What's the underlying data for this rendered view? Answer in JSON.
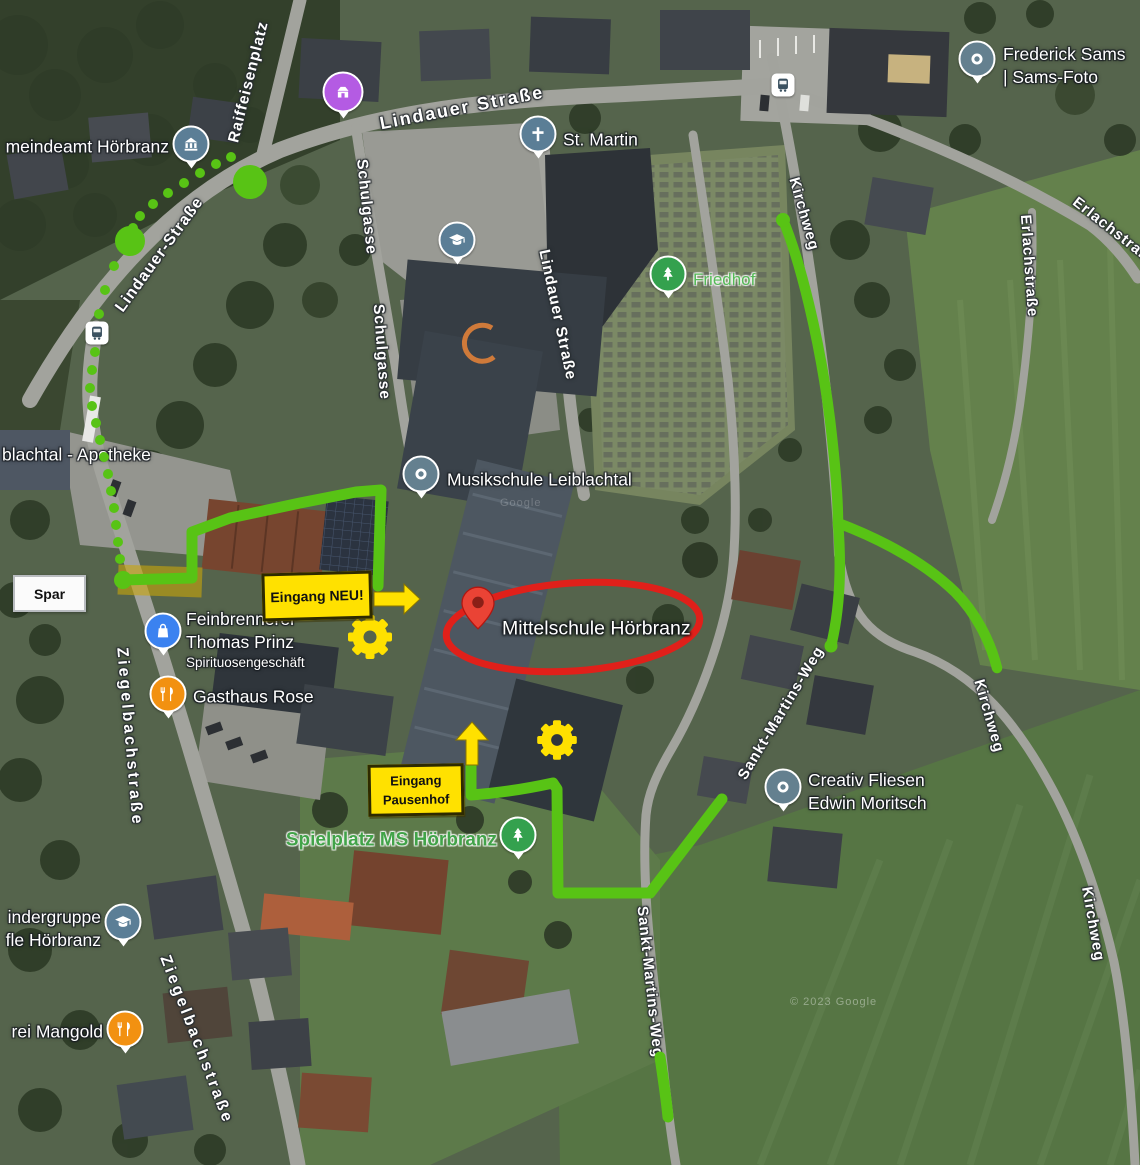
{
  "colors": {
    "route_green": "#58c315",
    "annotation_yellow": "#ffe100",
    "annotation_red": "#e0201a",
    "poi_blue_grey": "#5b7e96",
    "poi_generic_grey": "#64808f",
    "poi_green": "#34a14e",
    "poi_blue": "#3b82f0",
    "poi_orange": "#f29111",
    "poi_purple": "#b45be3",
    "pin_red": "#ea4335"
  },
  "annotations": {
    "eingang_neu": "Eingang NEU!",
    "eingang_pausenhof_line1": "Eingang",
    "eingang_pausenhof_line2": "Pausenhof",
    "spar": "Spar",
    "target_label": "Mittelschule Hörbranz",
    "watermark_small": "Google",
    "watermark_bottom": "© 2023 Google"
  },
  "street_labels": [
    {
      "text": "Raiffeisenplatz",
      "x": 249,
      "y": 82,
      "rot": -76,
      "size": 15.5,
      "sp": 1
    },
    {
      "text": "Lindauer Straße",
      "x": 462,
      "y": 108,
      "rot": -11,
      "size": 18,
      "sp": 2
    },
    {
      "text": "Lindauer-Straße",
      "x": 160,
      "y": 255,
      "rot": -54,
      "size": 16,
      "sp": 1
    },
    {
      "text": "Schulgasse",
      "x": 366,
      "y": 207,
      "rot": 84,
      "size": 15.5,
      "sp": 1
    },
    {
      "text": "Schulgasse",
      "x": 381,
      "y": 352,
      "rot": 86,
      "size": 15.5,
      "sp": 1
    },
    {
      "text": "Lindauer Straße",
      "x": 557,
      "y": 315,
      "rot": 78,
      "size": 15.5,
      "sp": 1
    },
    {
      "text": "Kirchweg",
      "x": 804,
      "y": 214,
      "rot": 74,
      "size": 15,
      "sp": 1
    },
    {
      "text": "Erlachstraße",
      "x": 1115,
      "y": 232,
      "rot": 38,
      "size": 15,
      "sp": 1
    },
    {
      "text": "Erlachstraße",
      "x": 1029,
      "y": 266,
      "rot": 86,
      "size": 15,
      "sp": 1
    },
    {
      "text": "Kirchweg",
      "x": 989,
      "y": 716,
      "rot": 74,
      "size": 15,
      "sp": 1
    },
    {
      "text": "Kirchweg",
      "x": 1093,
      "y": 924,
      "rot": 80,
      "size": 15,
      "sp": 1
    },
    {
      "text": "Sankt-Martins-Weg",
      "x": 781,
      "y": 713,
      "rot": -59,
      "size": 15,
      "sp": 1
    },
    {
      "text": "Sankt-Martins-Weg",
      "x": 650,
      "y": 982,
      "rot": 84,
      "size": 15,
      "sp": 1
    },
    {
      "text": "Ziegelbachstraße",
      "x": 129,
      "y": 737,
      "rot": 85,
      "size": 16,
      "sp": 3
    },
    {
      "text": "Ziegelbachstraße",
      "x": 196,
      "y": 1040,
      "rot": 69,
      "size": 16,
      "sp": 3
    }
  ],
  "pois": [
    {
      "icon": "townhall-icon",
      "color": "#5b7e96",
      "x": 191,
      "y": 147,
      "label": {
        "lines": [
          {
            "t": "meindeamt Hörbranz"
          }
        ],
        "x": 169,
        "y": 147,
        "align": "left",
        "color": "#fff",
        "size": 17.5
      }
    },
    {
      "icon": "store-icon",
      "color": "#b45be3",
      "x": 343,
      "y": 95,
      "big": true
    },
    {
      "icon": "cross-icon",
      "color": "#5b7e96",
      "x": 538,
      "y": 137,
      "label": {
        "lines": [
          {
            "t": "St. Martin"
          }
        ],
        "x": 563,
        "y": 140,
        "align": "right",
        "color": "#fff",
        "size": 17.5
      }
    },
    {
      "icon": "gradcap-icon",
      "color": "#5b7e96",
      "x": 457,
      "y": 243
    },
    {
      "icon": "tree-icon",
      "color": "#34a14e",
      "x": 668,
      "y": 277,
      "label": {
        "lines": [
          {
            "t": "Friedhof"
          }
        ],
        "x": 693,
        "y": 280,
        "align": "right",
        "color": "#55b957",
        "size": 17,
        "green": true
      }
    },
    {
      "icon": "dot-icon",
      "color": "#64808f",
      "x": 977,
      "y": 62,
      "label": {
        "lines": [
          {
            "t": "Frederick Sams"
          },
          {
            "t": "| Sams-Foto"
          }
        ],
        "x": 1003,
        "y": 66,
        "align": "right",
        "color": "#fff",
        "size": 17.5
      }
    },
    {
      "icon": "bus-icon",
      "special": "bus",
      "x": 783,
      "y": 85
    },
    {
      "icon": "bus-icon",
      "special": "bus",
      "x": 97,
      "y": 333
    },
    {
      "icon": "dot-icon",
      "color": "#64808f",
      "x": 421,
      "y": 477,
      "label": {
        "lines": [
          {
            "t": "Musikschule Leiblachtal"
          }
        ],
        "x": 447,
        "y": 480,
        "align": "right",
        "color": "#fff",
        "size": 17.5
      }
    },
    {
      "icon": "bag-icon",
      "color": "#3b82f0",
      "x": 163,
      "y": 634,
      "label": {
        "lines": [
          {
            "t": "Feinbrennerei"
          },
          {
            "t": "Thomas Prinz"
          },
          {
            "t": "Spirituosengeschäft",
            "size": 13.5
          }
        ],
        "x": 186,
        "y": 640,
        "align": "right",
        "color": "#fff",
        "size": 17.5
      }
    },
    {
      "icon": "fork-icon",
      "color": "#f29111",
      "x": 168,
      "y": 697,
      "label": {
        "lines": [
          {
            "t": "Gasthaus Rose"
          }
        ],
        "x": 193,
        "y": 697,
        "align": "right",
        "color": "#fff",
        "size": 17.5
      }
    },
    {
      "icon": "tree-icon",
      "color": "#34a14e",
      "x": 518,
      "y": 838,
      "label": {
        "lines": [
          {
            "t": "Spielplatz MS Hörbranz"
          }
        ],
        "x": 497,
        "y": 840,
        "align": "left",
        "color": "#42a349",
        "size": 19,
        "green": true,
        "bold": true
      }
    },
    {
      "icon": "dot-icon",
      "color": "#64808f",
      "x": 783,
      "y": 790,
      "label": {
        "lines": [
          {
            "t": "Creativ Fliesen"
          },
          {
            "t": "Edwin Moritsch"
          }
        ],
        "x": 808,
        "y": 792,
        "align": "right",
        "color": "#fff",
        "size": 17.5
      }
    },
    {
      "icon": "gradcap-icon",
      "color": "#5b7e96",
      "x": 123,
      "y": 925,
      "label": {
        "lines": [
          {
            "t": "indergruppe"
          },
          {
            "t": "fle Hörbranz"
          }
        ],
        "x": 101,
        "y": 929,
        "align": "left",
        "color": "#fff",
        "size": 17.5
      }
    },
    {
      "icon": "fork-icon",
      "color": "#f29111",
      "x": 125,
      "y": 1032,
      "label": {
        "lines": [
          {
            "t": "rei Mangold"
          }
        ],
        "x": 103,
        "y": 1032,
        "align": "left",
        "color": "#fff",
        "size": 17.5
      }
    }
  ],
  "plain_labels": [
    {
      "text": "blachtal - Apotheke",
      "x": 2,
      "y": 455,
      "size": 17.5,
      "color": "#fff"
    }
  ]
}
